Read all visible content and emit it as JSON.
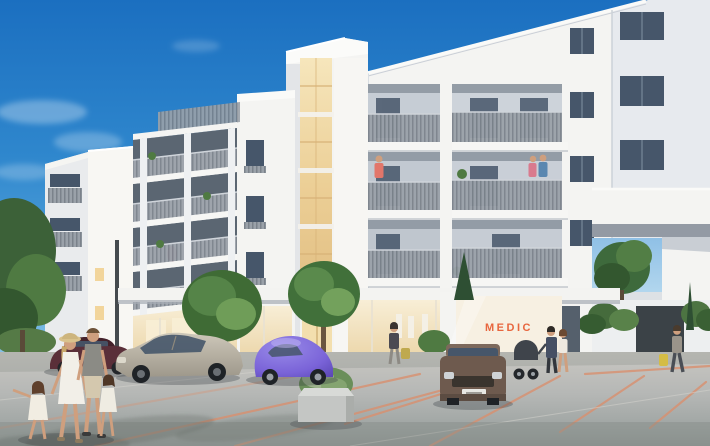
{
  "scene": {
    "type": "architectural exterior rendering",
    "title": "Modern white apartment complex with ground-floor shops and plaza",
    "signage": {
      "medic_sign": "MEDIC"
    },
    "elements": {
      "buildings": [
        "left residential wing with slat balconies",
        "central stair tower with amber glazing strip",
        "main block with deep recessed balconies",
        "right wing joined by bridge section over passage"
      ],
      "vehicles": [
        "maroon sedan",
        "silver hatchback",
        "purple beetle",
        "brown compact car parked frontal",
        "baby stroller"
      ],
      "people": [
        "family of four crossing the plaza",
        "woman with bag at left storefront",
        "couple with stroller by MEDIC store",
        "pedestrian near right passage",
        "resident in coral top on balcony",
        "couple on center balcony"
      ],
      "vegetation": [
        "tall trees at left edge",
        "round storefront trees",
        "cypress by shopfront",
        "shrub in concrete planter",
        "hedges at right passage",
        "tree seen through archway"
      ]
    }
  },
  "colors": {
    "sky_top": "#1b6fc0",
    "sky_horizon": "#cfeaf6",
    "facade_white": "#f4f4f2",
    "facade_shade": "#e7eaee",
    "glazing_amber": "#eed3a0",
    "railing_gray": "#98a0a9",
    "window_glass": "#46566a",
    "storefront_glow": "#f6ead0",
    "medic_orange": "#e8663e",
    "pavement_light": "#c9c7c2",
    "pavement_dark": "#8f9694",
    "marking_salmon": "#d9906f",
    "foliage_green": "#4f7a42",
    "car_maroon": "#5a2f39",
    "car_silver": "#b8b2a4",
    "car_purple": "#7a63d8",
    "car_brown": "#6e5a4e"
  }
}
